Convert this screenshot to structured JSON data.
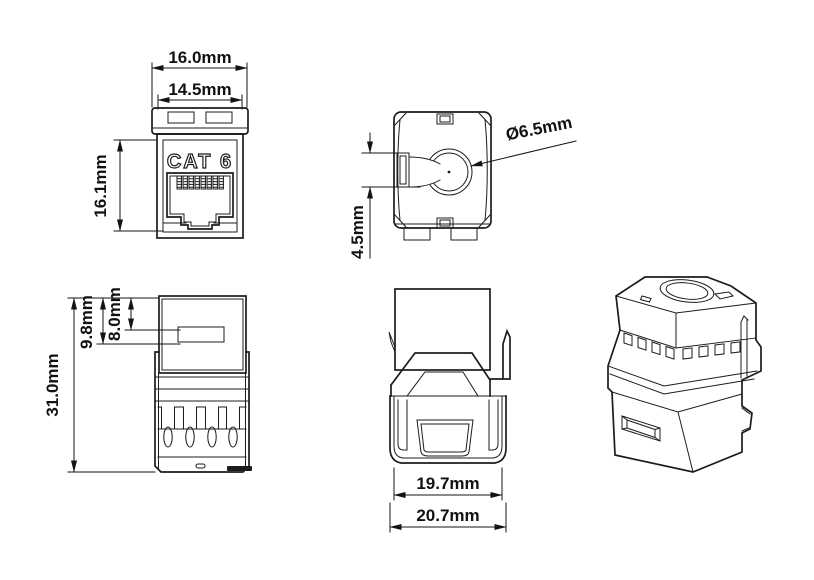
{
  "drawing": {
    "kind": "keystone jack dimension drawing",
    "background": "#ffffff",
    "line_color": "#1c1c1c",
    "text_color": "#111111"
  },
  "views": {
    "front": {
      "title": "front view",
      "face_label": "CAT 6",
      "dim_width_outer": "16.0mm",
      "dim_width_inner": "14.5mm",
      "dim_height": "16.1mm"
    },
    "top": {
      "title": "top view",
      "dim_hole_diameter": "Ø6.5mm",
      "dim_latch_depth": "4.5mm"
    },
    "side": {
      "title": "side view",
      "dim_height_total": "31.0mm",
      "dim_cap_depth_outer": "9.8mm",
      "dim_cap_depth_inner": "8.0mm"
    },
    "rear": {
      "title": "rear view",
      "dim_width_inner": "19.7mm",
      "dim_width_outer": "20.7mm"
    },
    "isometric": {
      "title": "isometric view"
    }
  }
}
